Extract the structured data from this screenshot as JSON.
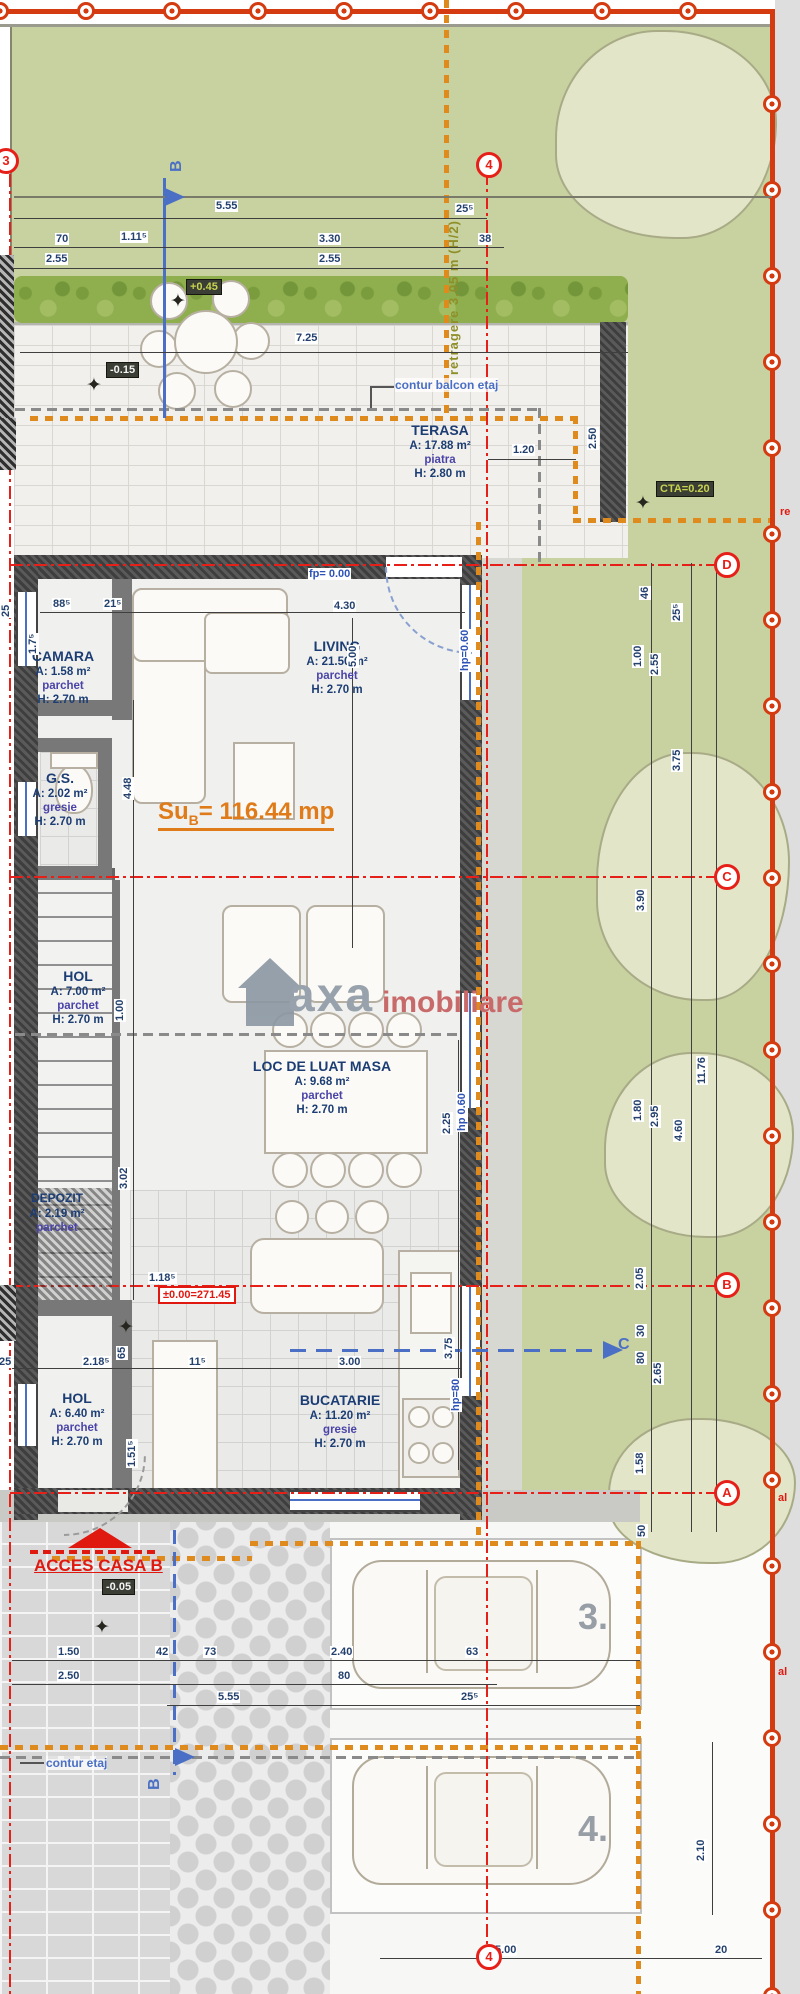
{
  "site": {
    "retragere": "retragere 3.05 m (H/2)",
    "re": "re",
    "al1": "al",
    "al2": "al",
    "contur_balcon": "contur balcon etaj",
    "contur_etaj": "contur etaj",
    "acces": "ACCES CASA B",
    "watermark1": "axa",
    "watermark2": "imobiliare"
  },
  "markers": {
    "m3": "3",
    "m4_top": "4",
    "m4_bottom": "4",
    "d": "D",
    "c": "C",
    "b": "B",
    "a": "A",
    "sec_b_top": "B",
    "sec_b_bottom": "B",
    "sec_c": "C"
  },
  "levels": {
    "hedge": "+0.45",
    "terrace": "-0.15",
    "cta": "CTA=0.20",
    "zero": "±0.00=271.45",
    "entry": "-0.05"
  },
  "total_area": {
    "label": "Su",
    "sub": "B",
    "value": "= 116.44 mp"
  },
  "rooms": {
    "terasa": {
      "name": "TERASA",
      "area": "A: 17.88 m²",
      "floor": "piatra",
      "height": "H: 2.80 m"
    },
    "camara": {
      "name": "CAMARA",
      "area": "A: 1.58 m²",
      "floor": "parchet",
      "height": "H: 2.70 m"
    },
    "living": {
      "name": "LIVING",
      "area": "A: 21.50 m²",
      "floor": "parchet",
      "height": "H: 2.70 m"
    },
    "gs": {
      "name": "G.S.",
      "area": "A: 2.02 m²",
      "floor": "gresie",
      "height": "H: 2.70 m"
    },
    "hol1": {
      "name": "HOL",
      "area": "A: 7.00 m²",
      "floor": "parchet",
      "height": "H: 2.70 m"
    },
    "masa": {
      "name": "LOC DE LUAT MASA",
      "area": "A: 9.68 m²",
      "floor": "parchet",
      "height": "H: 2.70 m"
    },
    "depozit": {
      "name": "DEPOZIT",
      "area": "A: 2.19 m²",
      "floor": "parchet"
    },
    "hol2": {
      "name": "HOL",
      "area": "A: 6.40 m²",
      "floor": "parchet",
      "height": "H: 2.70 m"
    },
    "bucatarie": {
      "name": "BUCATARIE",
      "area": "A: 11.20 m²",
      "floor": "gresie",
      "height": "H: 2.70 m"
    }
  },
  "parking": {
    "p3": "3.",
    "p4": "4."
  },
  "dims": {
    "t555": "5.55",
    "t70": "70",
    "t1115": "1.11⁵",
    "t330": "3.30",
    "t255a": "2.55",
    "t255b": "2.55",
    "t2555": "25⁵",
    "t38": "38",
    "t725": "7.25",
    "t250": "2.50",
    "t120": "1.20",
    "t885": "88⁵",
    "t215": "21⁵",
    "t430": "4.30",
    "t500": "5.00",
    "t25a": "25",
    "t175": "1.7⁵",
    "t448": "4.48",
    "t100i": "1.00",
    "t302": "3.02",
    "t1185": "1.18⁵",
    "t65": "65",
    "t225": "2.25",
    "t375k": "3.75",
    "t2185": "2.18⁵",
    "t115": "11⁵",
    "t300": "3.00",
    "t25b": "25",
    "t1515": "1.51⁵",
    "fp": "fp= 0.00",
    "hp1": "hp=0.60",
    "hp2": "hp 0.60",
    "hp3": "hp=80",
    "r46": "46",
    "r2555": "25⁵",
    "r100": "1.00",
    "r255": "2.55",
    "r375": "3.75",
    "r390": "3.90",
    "r1176": "11.76",
    "r180": "1.80",
    "r295": "2.95",
    "r460": "4.60",
    "r205": "2.05",
    "r30": "30",
    "r80": "80",
    "r265": "2.65",
    "r158": "1.58",
    "r50": "50",
    "b150": "1.50",
    "b42": "42",
    "b73": "73",
    "b240": "2.40",
    "b63": "63",
    "b250": "2.50",
    "b80": "80",
    "b555": "5.55",
    "b2555": "25⁵",
    "v210": "2.10",
    "b500": "5.00",
    "b20": "20"
  }
}
